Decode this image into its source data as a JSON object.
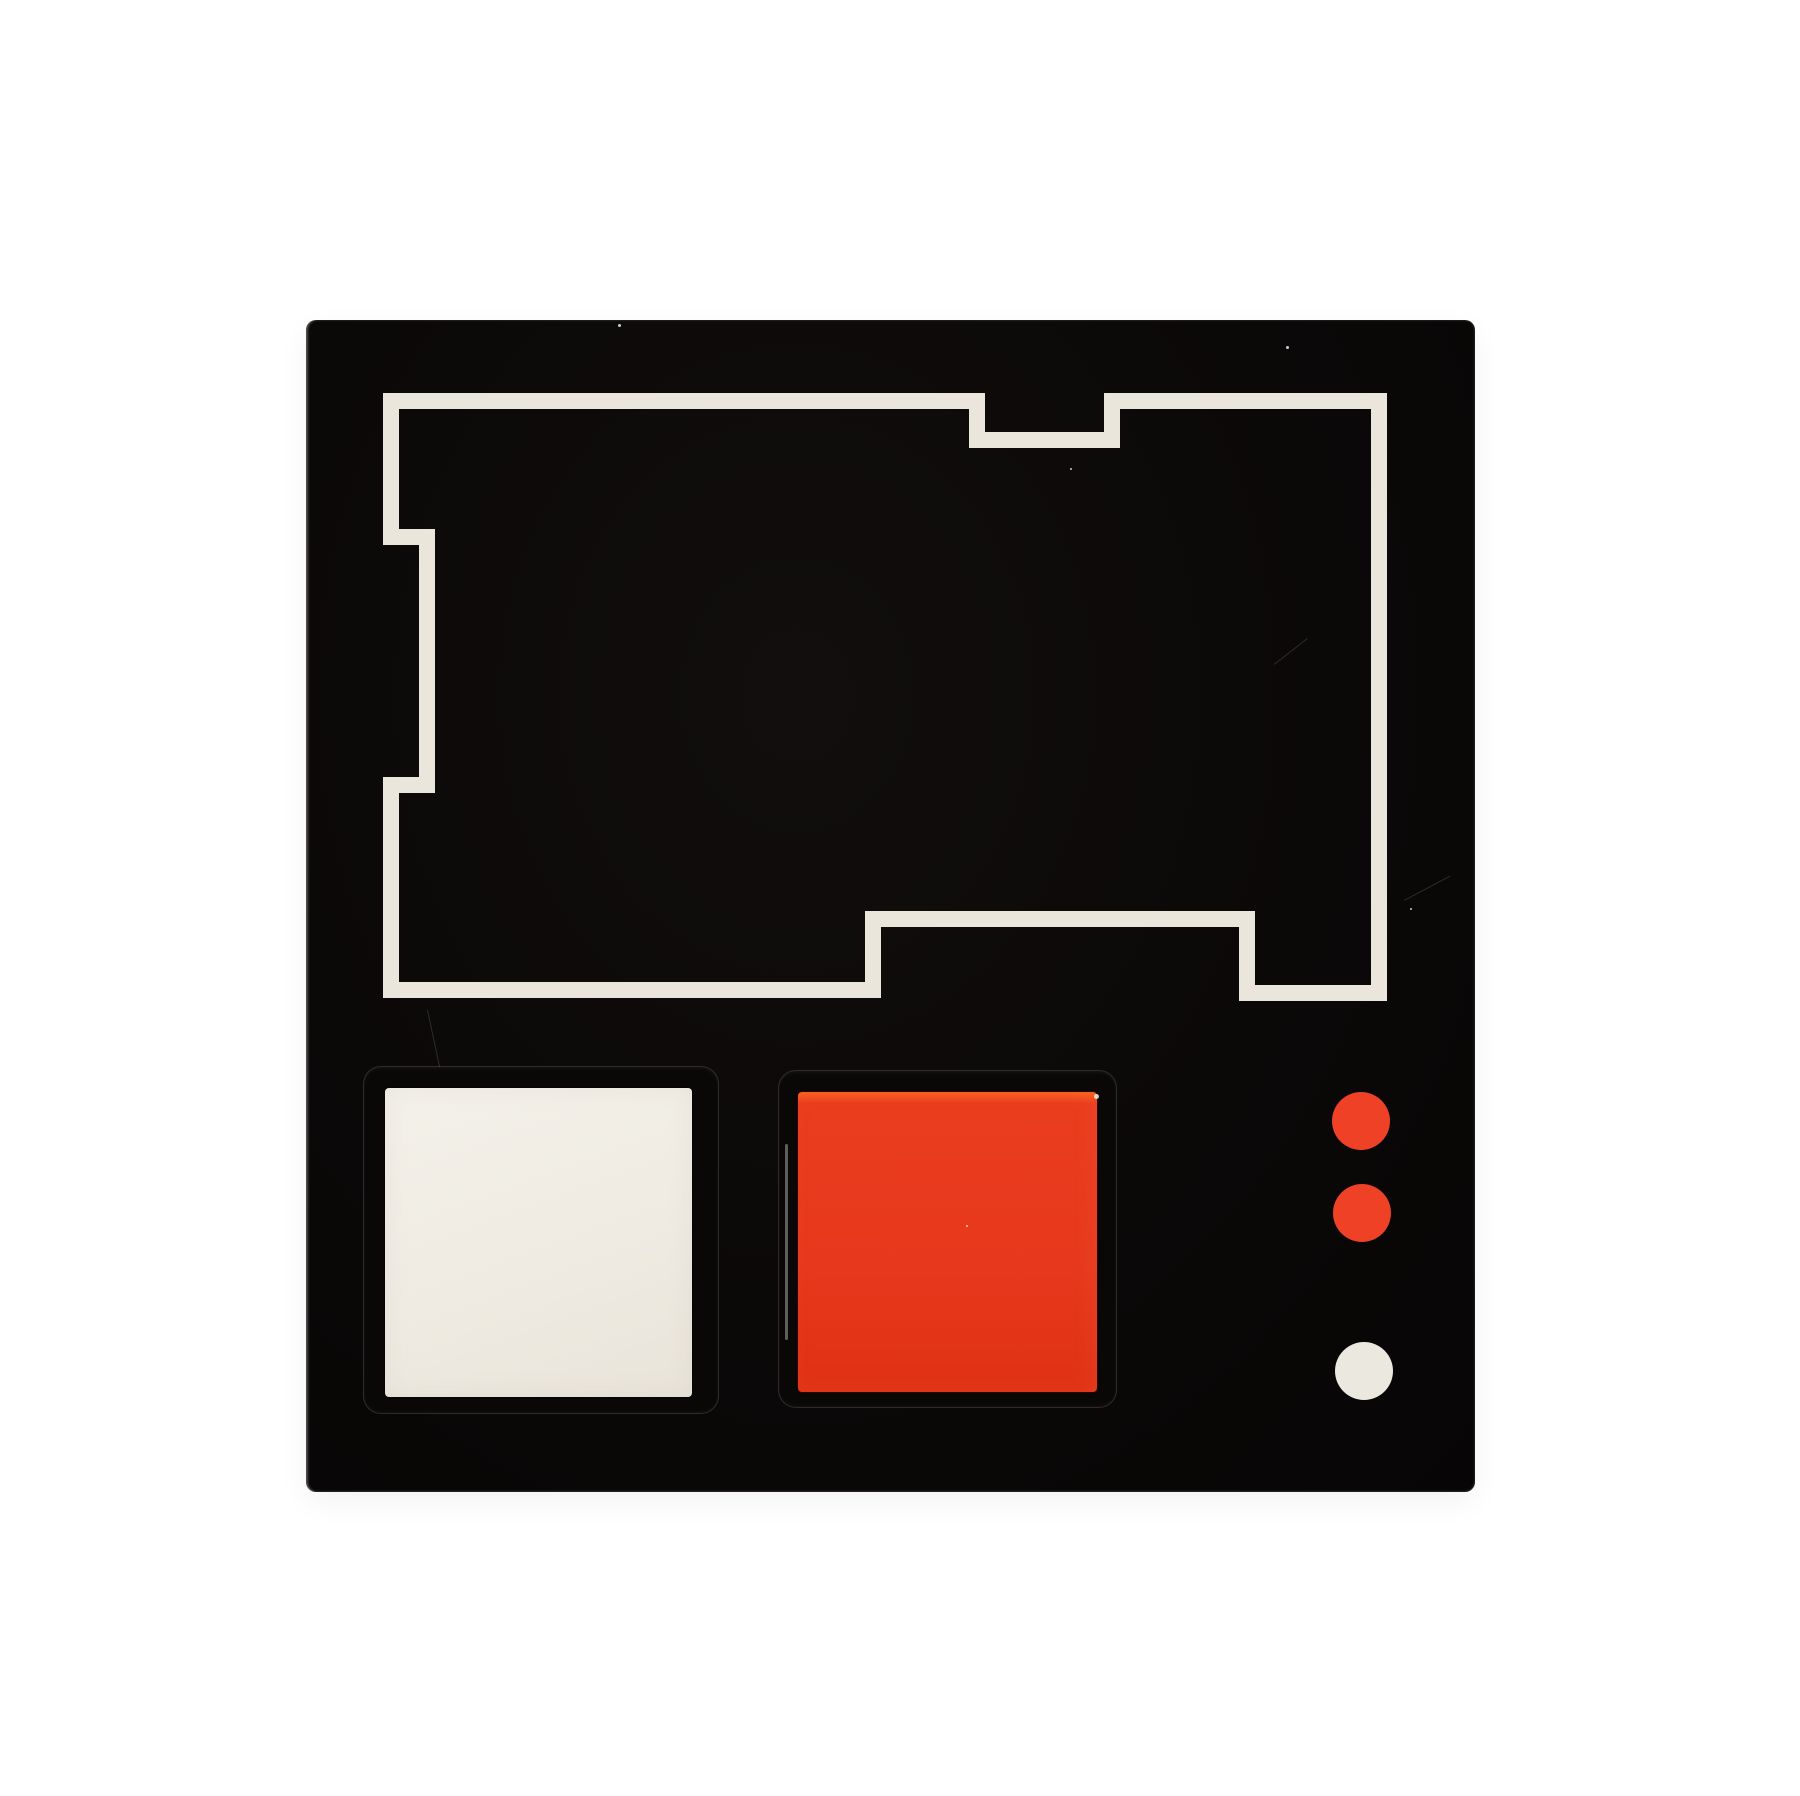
{
  "canvas": {
    "width": 1800,
    "height": 1796,
    "background": "#ffffff"
  },
  "panel": {
    "x": 306,
    "y": 320,
    "width": 1169,
    "height": 1172,
    "color": "#0b0808",
    "edge_highlight": "#c9c5bf"
  },
  "outline_shape": {
    "color": "#eae6dc",
    "stroke_width": 16,
    "points": [
      [
        85,
        81
      ],
      [
        671,
        81
      ],
      [
        671,
        120
      ],
      [
        806,
        120
      ],
      [
        806,
        81
      ],
      [
        1073,
        81
      ],
      [
        1073,
        673
      ],
      [
        941,
        673
      ],
      [
        941,
        599
      ],
      [
        567,
        599
      ],
      [
        567,
        670
      ],
      [
        85,
        670
      ],
      [
        85,
        465
      ],
      [
        121,
        465
      ],
      [
        121,
        217
      ],
      [
        85,
        217
      ]
    ]
  },
  "white_button": {
    "bezel": {
      "x": 57,
      "y": 746,
      "width": 356,
      "height": 348,
      "color": "#0a0707"
    },
    "face": {
      "x": 79,
      "y": 768,
      "width": 307,
      "height": 309,
      "color": "#f1eee6"
    }
  },
  "red_button": {
    "bezel": {
      "x": 472,
      "y": 750,
      "width": 339,
      "height": 338,
      "color": "#0a0707"
    },
    "face": {
      "x": 492,
      "y": 772,
      "width": 299,
      "height": 298,
      "color": "#e8391e",
      "top_edge_color": "#f75d1f"
    }
  },
  "indicator_dots": [
    {
      "id": "red-indicator-dot-1",
      "cx": 1055,
      "cy": 801,
      "r": 29,
      "color": "#ee4126"
    },
    {
      "id": "red-indicator-dot-2",
      "cx": 1056,
      "cy": 893,
      "r": 29,
      "color": "#ee4126"
    },
    {
      "id": "white-indicator-dot",
      "cx": 1058,
      "cy": 1051,
      "r": 29,
      "color": "#ebe8df"
    }
  ],
  "specks": [
    {
      "x": 788,
      "y": 774,
      "s": 5
    },
    {
      "x": 980,
      "y": 26,
      "s": 3
    },
    {
      "x": 312,
      "y": 4,
      "s": 3
    },
    {
      "x": 1104,
      "y": 588,
      "s": 2
    },
    {
      "x": 660,
      "y": 905,
      "s": 2
    },
    {
      "x": 764,
      "y": 148,
      "s": 2
    }
  ],
  "scratches": [
    {
      "x": 968,
      "y": 344,
      "length": 42,
      "angle": -38
    },
    {
      "x": 1098,
      "y": 580,
      "length": 52,
      "angle": -28
    },
    {
      "x": 122,
      "y": 690,
      "length": 58,
      "angle": 78
    }
  ]
}
